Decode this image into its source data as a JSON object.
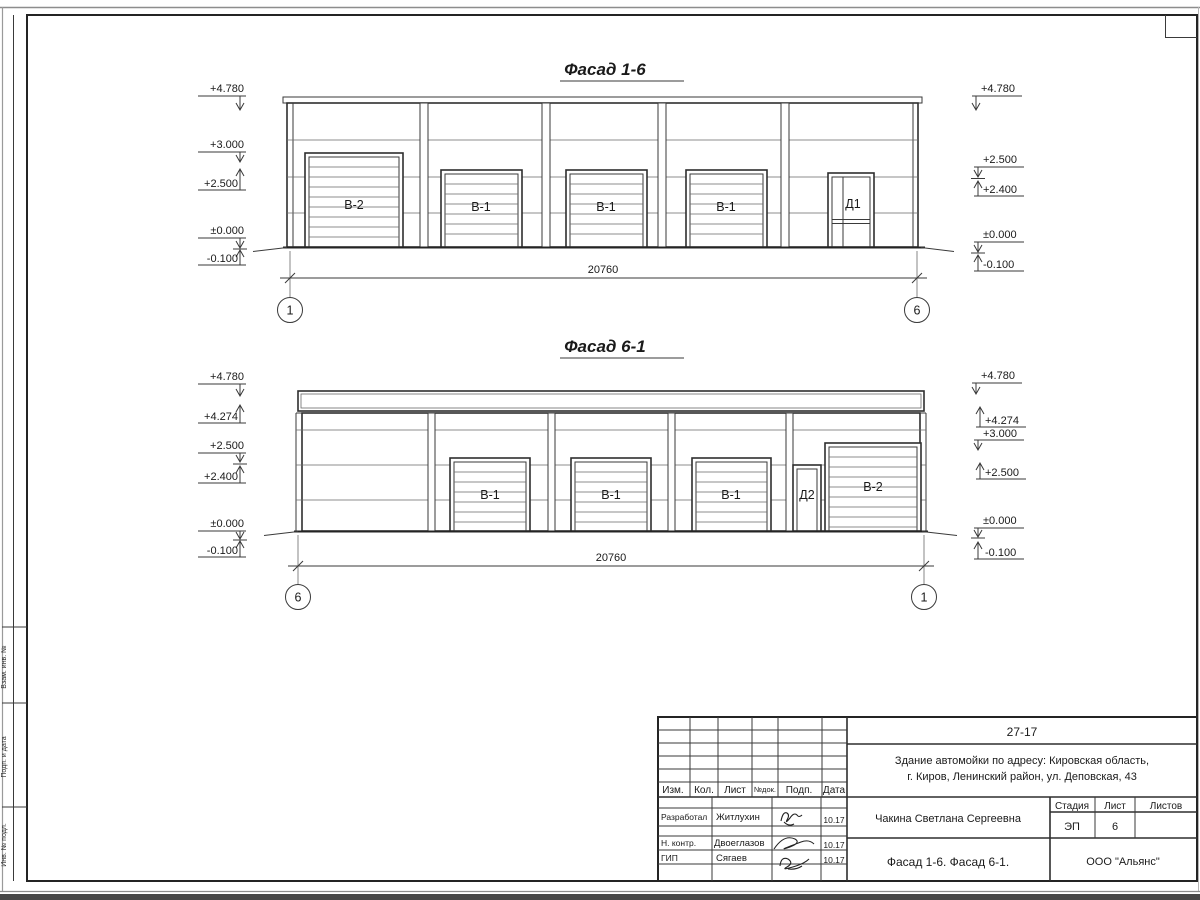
{
  "sheet_code_box": "",
  "facade1": {
    "title": "Фасад 1-6",
    "dim": "20760",
    "axisL": "1",
    "axisR": "6",
    "doors": [
      "В-2",
      "В-1",
      "В-1",
      "В-1",
      "Д1"
    ],
    "marksL": [
      "+4.780",
      "+3.000",
      "+2.500",
      "±0.000",
      "-0.100"
    ],
    "marksR": [
      "+4.780",
      "+2.500",
      "+2.400",
      "±0.000",
      "-0.100"
    ]
  },
  "facade2": {
    "title": "Фасад 6-1",
    "dim": "20760",
    "axisL": "6",
    "axisR": "1",
    "doors": [
      "В-1",
      "В-1",
      "В-1",
      "Д2",
      "В-2"
    ],
    "marksL": [
      "+4.780",
      "+4.274",
      "+2.500",
      "+2.400",
      "±0.000",
      "-0.100"
    ],
    "marksR": [
      "+4.780",
      "+4.274",
      "+3.000",
      "+2.500",
      "±0.000",
      "-0.100"
    ]
  },
  "stamp": {
    "project_code": "27-17",
    "project_line1": "Здание автомойки по адресу: Кировская область,",
    "project_line2": "г. Киров, Ленинский район, ул. Деповская, 43",
    "header": {
      "izm": "Изм.",
      "kol": "Кол.",
      "list": "Лист",
      "ndok": "№док.",
      "podp": "Подп.",
      "data": "Дата"
    },
    "rows": [
      {
        "role": "Разработал",
        "name": "Житлухин",
        "date": "10.17"
      },
      {
        "role": "Н. контр.",
        "name": "Двоеглазов",
        "date": "10.17"
      },
      {
        "role": "ГИП",
        "name": "Сягаев",
        "date": "10.17"
      }
    ],
    "client": "Чакина Светлана Сергеевна",
    "sheet_title": "Фасад 1-6. Фасад 6-1.",
    "org": "ООО \"Альянс\"",
    "stage_label": "Стадия",
    "stage": "ЭП",
    "list_label": "Лист",
    "list": "6",
    "listov_label": "Листов",
    "listov": ""
  },
  "margin_labels": [
    "Взам. инв. №",
    "Подп. и дата",
    "Инв. № подл."
  ]
}
